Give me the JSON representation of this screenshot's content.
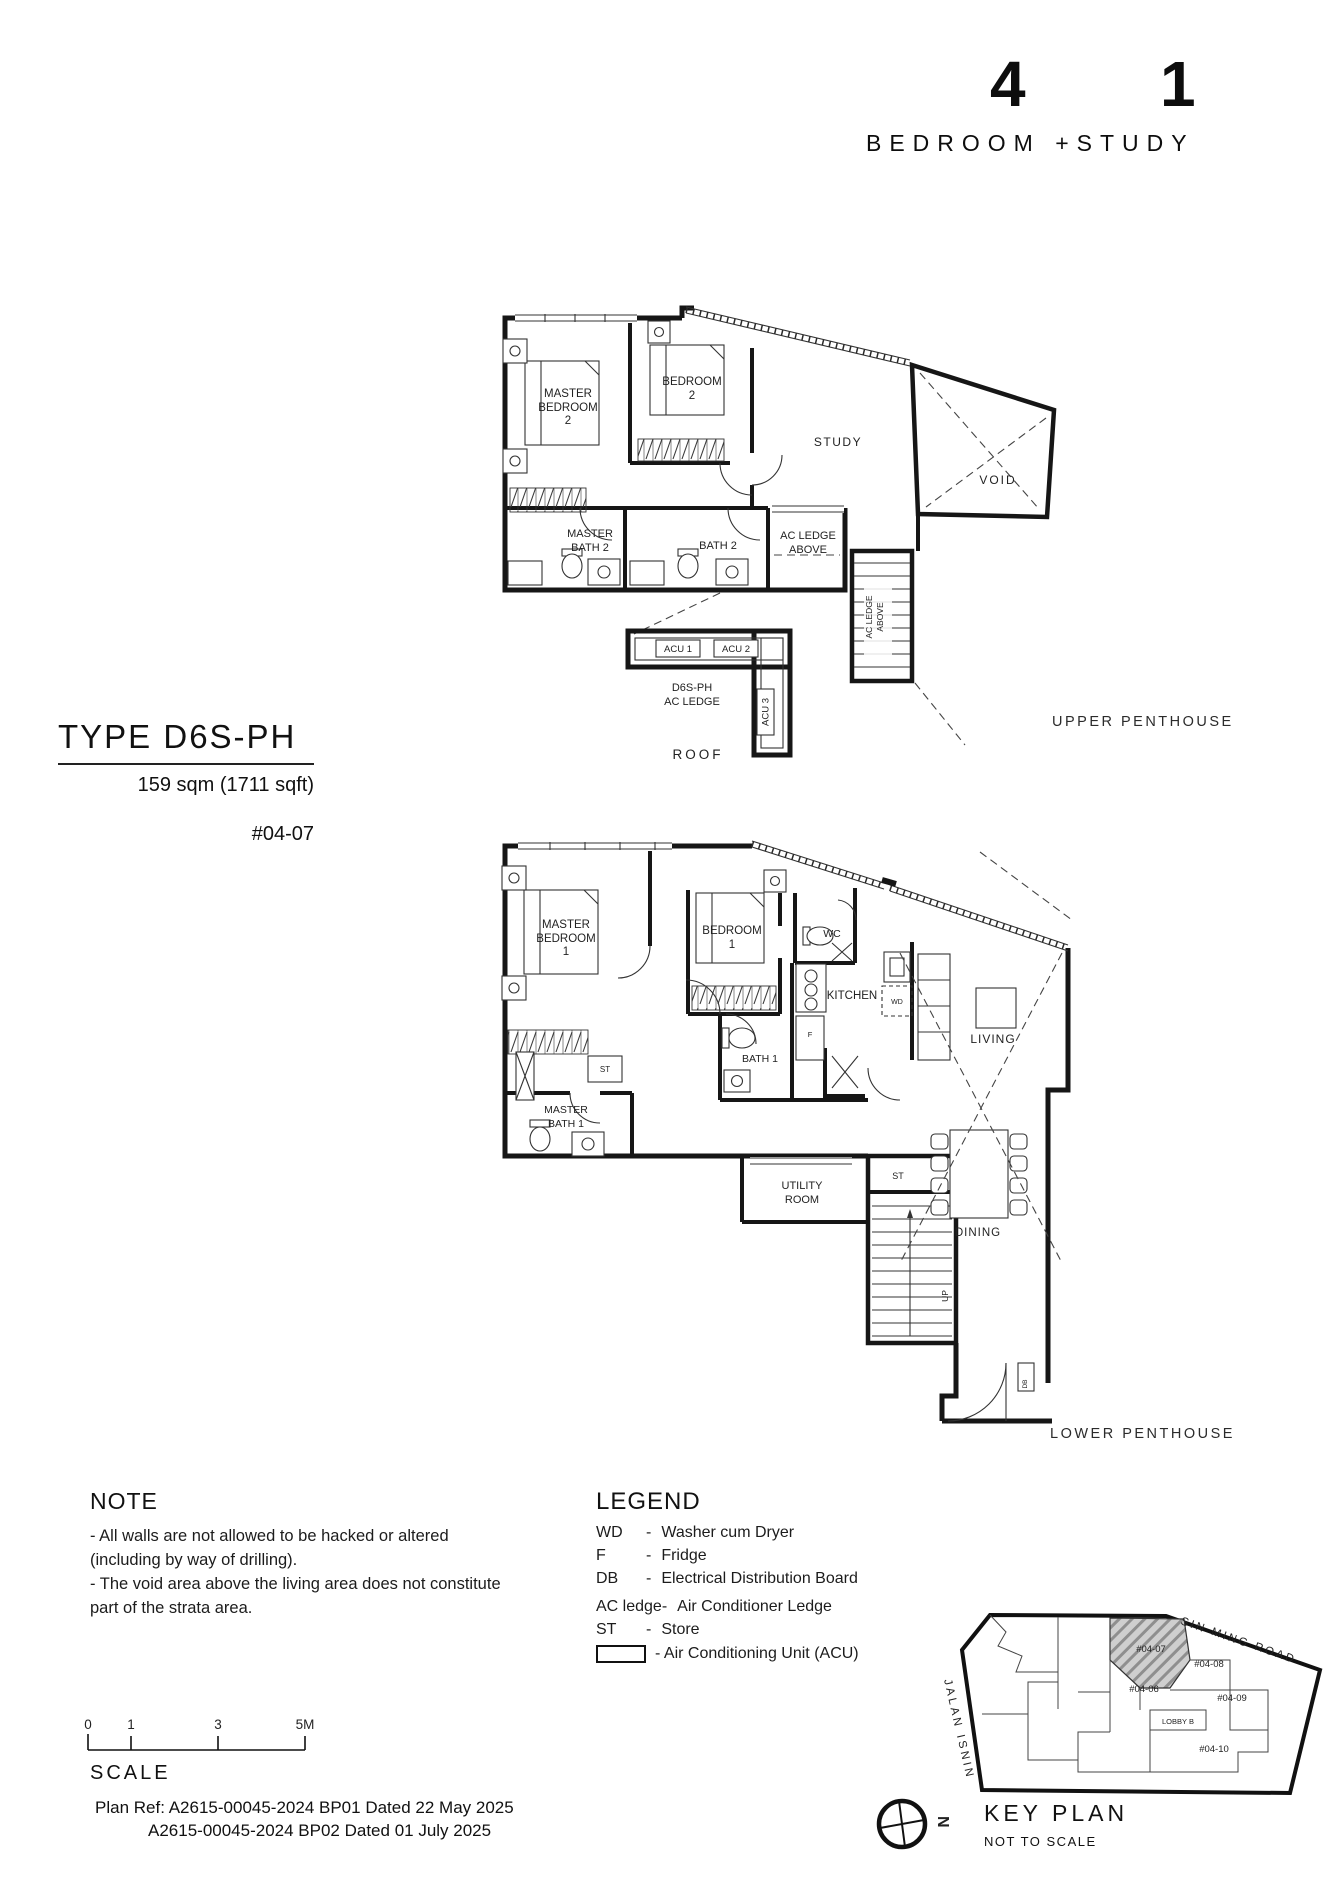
{
  "title": {
    "big": [
      "4",
      "1"
    ],
    "subtitle": "BEDROOM +STUDY"
  },
  "type_block": {
    "type_label": "TYPE D6S-PH",
    "area": "159 sqm (1711 sqft)",
    "unit_number": "#04-07"
  },
  "floor_labels": {
    "upper": "UPPER PENTHOUSE",
    "lower": "LOWER PENTHOUSE"
  },
  "upper_plan": {
    "master_bedroom": [
      "MASTER",
      "BEDROOM",
      "2"
    ],
    "bedroom": [
      "BEDROOM",
      "2"
    ],
    "study": "STUDY",
    "void": "VOID",
    "master_bath": [
      "MASTER",
      "BATH 2"
    ],
    "bath": "BATH 2",
    "ac_ledge_above": [
      "AC LEDGE",
      "ABOVE"
    ],
    "ac_ledge_above_stair": [
      "AC LEDGE",
      "ABOVE"
    ],
    "acu_1": "ACU 1",
    "acu_2": "ACU 2",
    "acu_3": "ACU 3",
    "ac_ledge_title": [
      "D6S-PH",
      "AC LEDGE"
    ],
    "roof": "ROOF"
  },
  "lower_plan": {
    "master_bedroom": [
      "MASTER",
      "BEDROOM",
      "1"
    ],
    "bedroom": [
      "BEDROOM",
      "1"
    ],
    "wc": "WC",
    "kitchen": "KITCHEN",
    "living": "LIVING",
    "bath": "BATH 1",
    "store_hall": "ST",
    "master_bath": [
      "MASTER",
      "BATH 1"
    ],
    "utility": [
      "UTILITY",
      "ROOM"
    ],
    "store_stair": "ST",
    "dining": "DINING",
    "up": "UP",
    "db": "DB",
    "fridge": "F",
    "washer": "WD"
  },
  "note": {
    "heading": "NOTE",
    "lines": [
      "-  All walls are not allowed to be hacked or altered",
      "(including by way of drilling).",
      "-  The void area above the living area does not constitute",
      "part of the strata area."
    ]
  },
  "legend": {
    "heading": "LEGEND",
    "separator": "-",
    "items": [
      {
        "abbr": "WD",
        "desc": "Washer cum Dryer"
      },
      {
        "abbr": "F",
        "desc": "Fridge"
      },
      {
        "abbr": "DB",
        "desc": "Electrical Distribution Board"
      },
      {
        "abbr": "AC ledge",
        "desc": "Air Conditioner Ledge"
      },
      {
        "abbr": "ST",
        "desc": "Store"
      }
    ],
    "acu_desc": "- Air Conditioning Unit (ACU)"
  },
  "scale_bar": {
    "label": "SCALE",
    "ticks": [
      "0",
      "1",
      "3",
      "5M"
    ]
  },
  "plan_ref": {
    "line1": "Plan Ref: A2615-00045-2024 BP01 Dated 22 May 2025",
    "line2": "A2615-00045-2024 BP02 Dated 01 July 2025"
  },
  "key_plan": {
    "heading": "KEY PLAN",
    "subheading": "NOT TO SCALE",
    "roads": {
      "top": "SIN MING ROAD",
      "left": "JALAN ISNIN"
    },
    "units": {
      "u0407": "#04-07",
      "u0408": "#04-08",
      "u0406": "#04-06",
      "u0409": "#04-09",
      "u0410": "#04-10",
      "lobby": "LOBBY B"
    },
    "north": "N"
  }
}
